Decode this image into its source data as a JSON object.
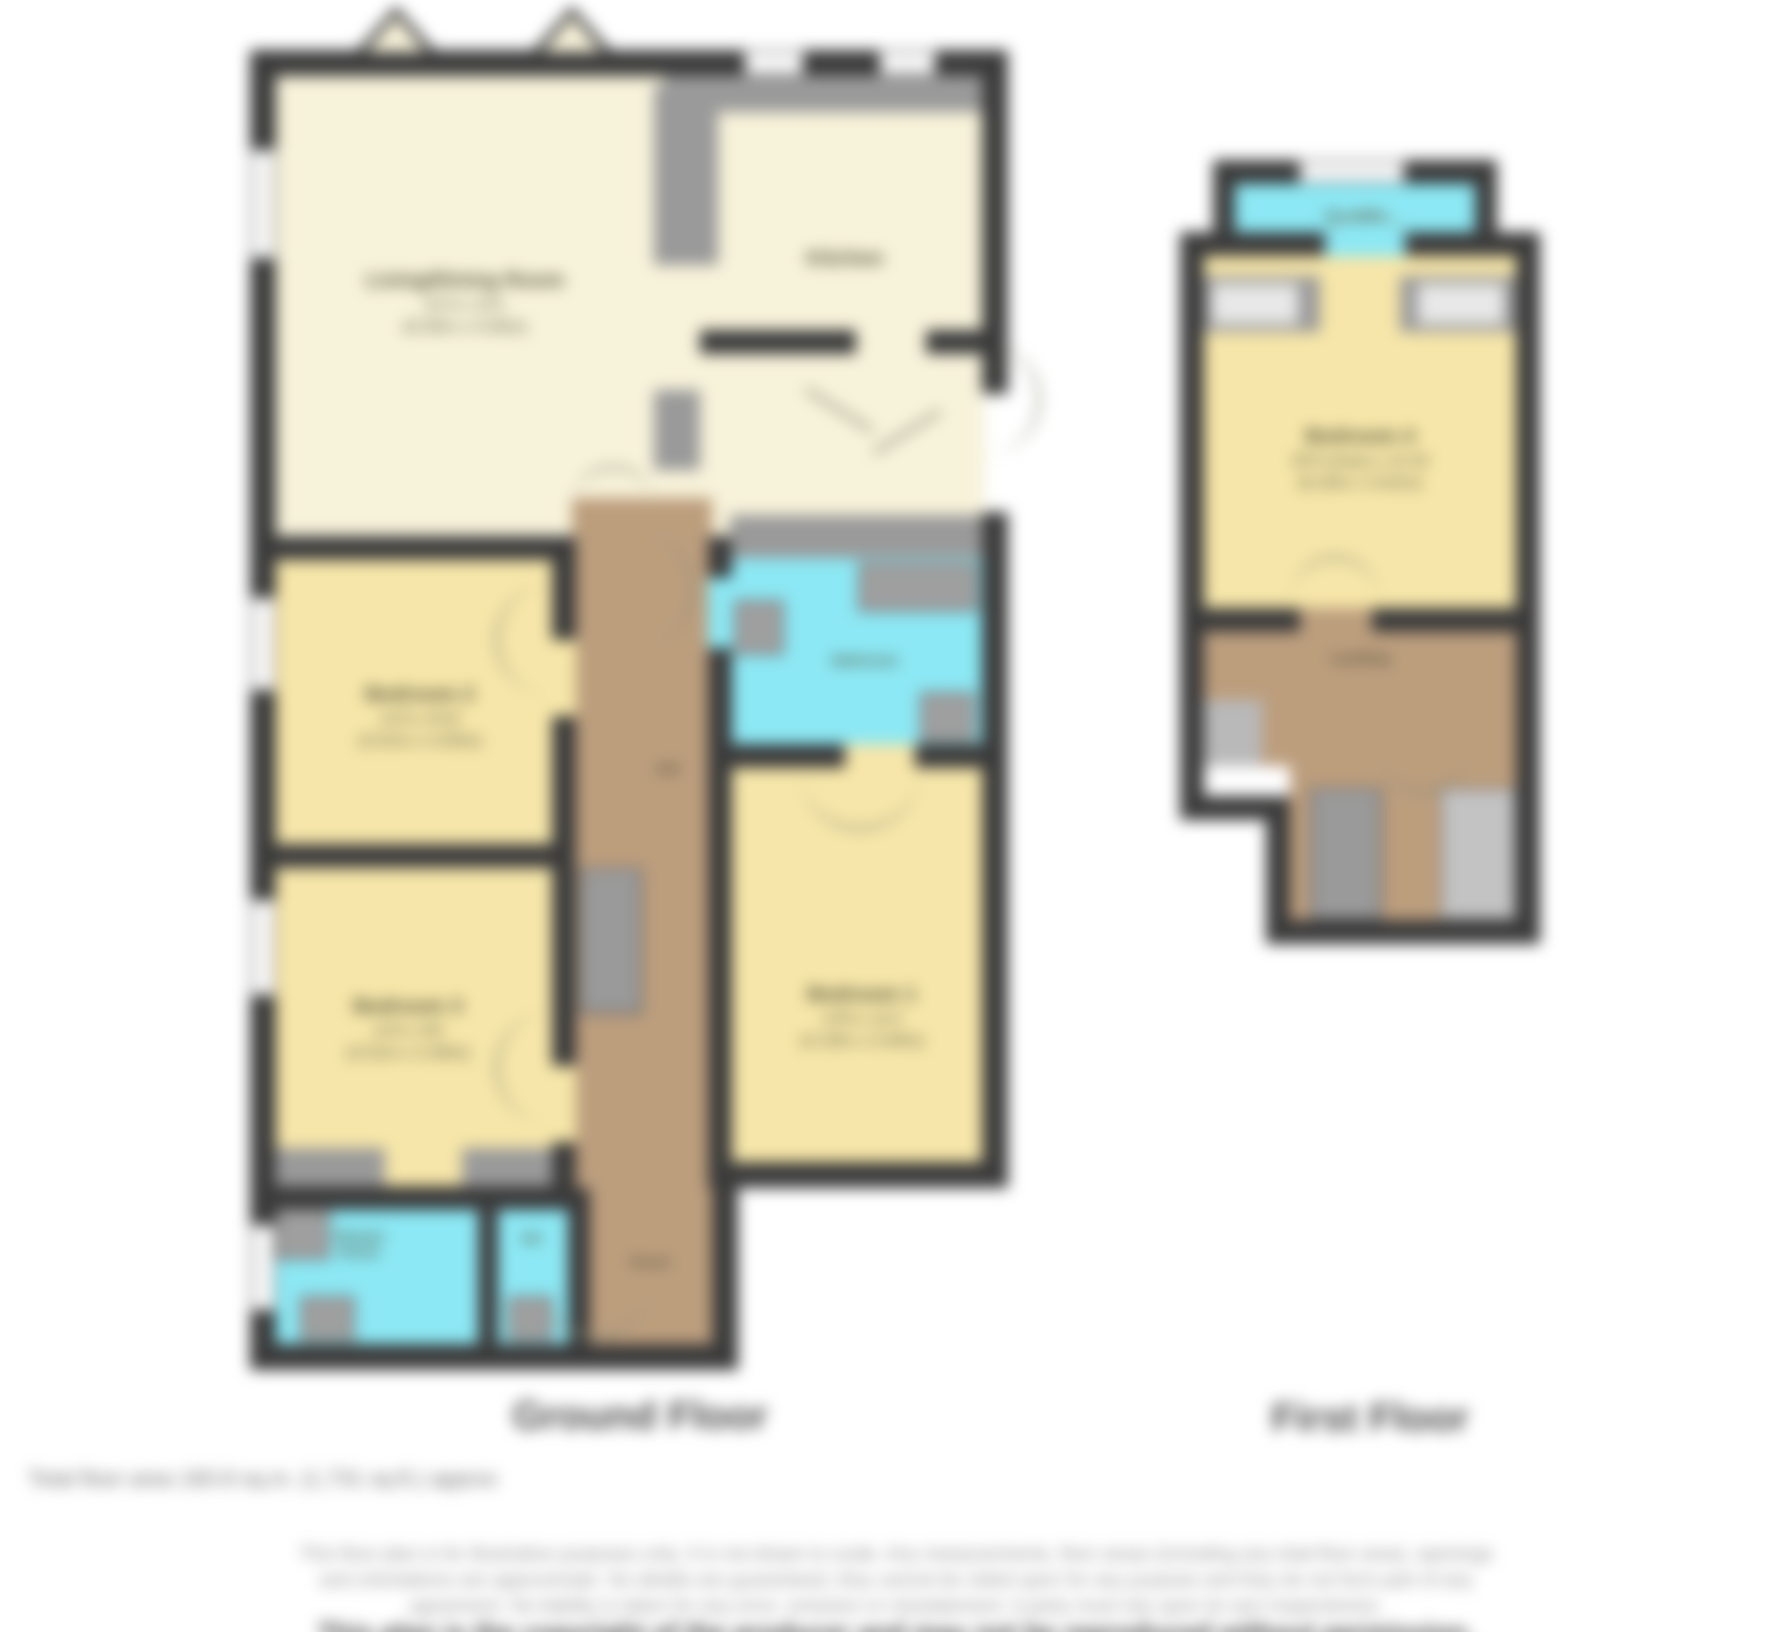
{
  "ground_floor": {
    "title": "Ground Floor",
    "rooms": {
      "living": {
        "name": "Living/Dining Room",
        "d1": "21'4 x 13'1",
        "d2": "(6.50m x 4.00m)"
      },
      "kitchen": {
        "name": "Kitchen"
      },
      "bathroom": {
        "name": "Bathroom"
      },
      "bedroom1": {
        "name": "Bedroom 1",
        "d1": "13'9 x 11'2",
        "d2": "(4.19m x 3.40m)"
      },
      "bedroom2": {
        "name": "Bedroom 2",
        "d1": "11'6 x 9'10",
        "d2": "(3.51m x 3.00m)"
      },
      "bedroom3": {
        "name": "Bedroom 3",
        "d1": "11'6 x 9'6",
        "d2": "(3.51m x 2.90m)"
      },
      "hall": {
        "name": "Hall"
      },
      "shower_room": {
        "line1": "Shower",
        "line2": "Room"
      },
      "wc": {
        "name": "WC"
      },
      "porch": {
        "name": "Porch"
      }
    }
  },
  "first_floor": {
    "title": "First Floor",
    "rooms": {
      "ensuite": {
        "name": "En-suite"
      },
      "bedroom4": {
        "name": "Bedroom 4",
        "d1": "20'4 (max) x 11'10",
        "d2": "(6.20m x 3.61m)"
      },
      "landing": {
        "name": "Landing"
      }
    }
  },
  "footer": {
    "total_area": "Total floor area 160.8 sq.m. (1,731 sq.ft.) approx",
    "disclaimer_line1": "This floor plan is for illustrative purposes only. It is not drawn to scale. Any measurements, floor areas (including any total floor area), openings",
    "disclaimer_line2": "and orientations are approximate. No details are guaranteed, they cannot be relied upon for any purpose and they do not form part of any",
    "disclaimer_line3": "agreement. No liability is taken for any error, omission or misstatement. A party must rely upon its own inspection(s).",
    "disclaimer_line4": "This plan is the copyright of the producer and may not be reproduced without permission."
  },
  "colors": {
    "wall": "#3b3b3b",
    "cream": "#f7f2da",
    "bedroom_yellow": "#f6e6a9",
    "wet_room_cyan": "#8ce8f4",
    "hall_brown": "#bc9e7d",
    "fixture_gray": "#9f9f9f"
  }
}
